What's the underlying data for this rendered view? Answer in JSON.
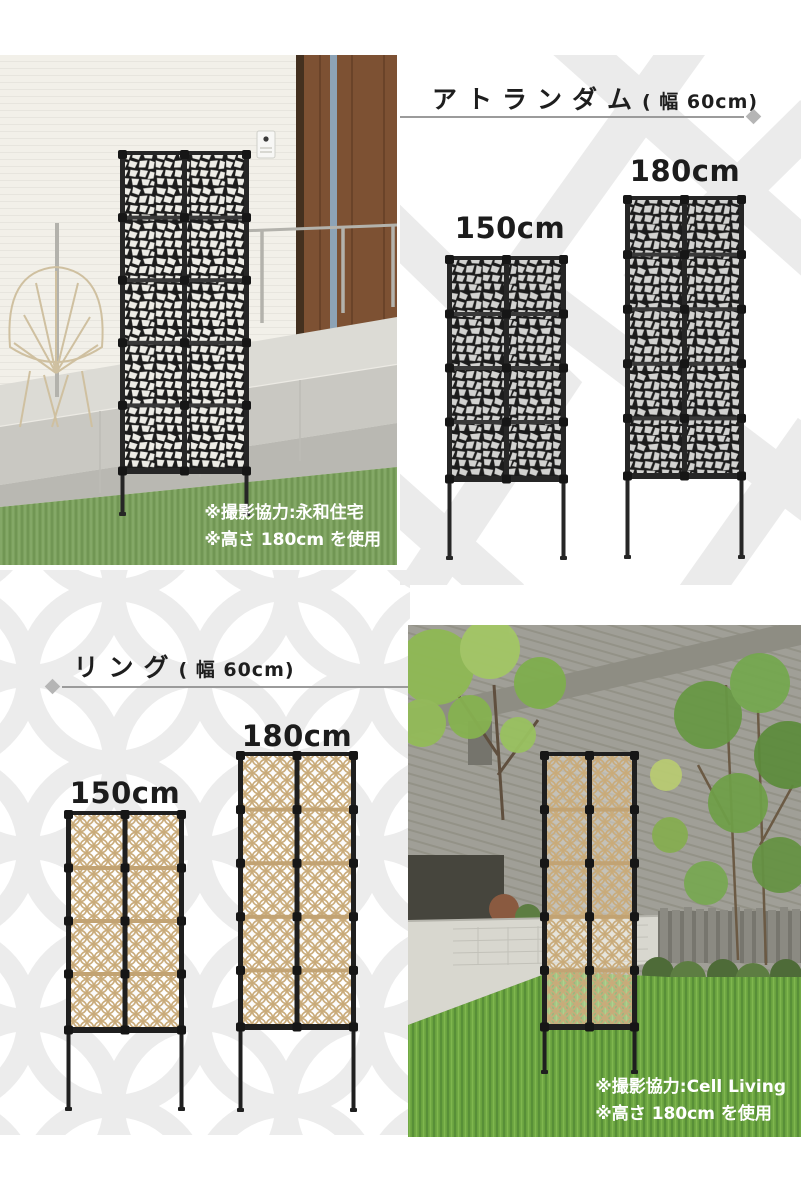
{
  "sections": {
    "atrandom": {
      "title": "アトランダム",
      "width_note": "( 幅 60cm)",
      "panel_style": "random",
      "sizes": [
        {
          "label": "150cm",
          "rows": 4,
          "cols": 2
        },
        {
          "label": "180cm",
          "rows": 5,
          "cols": 2
        }
      ]
    },
    "ring": {
      "title": "リング",
      "width_note": "( 幅 60cm)",
      "panel_style": "ring",
      "sizes": [
        {
          "label": "150cm",
          "rows": 4,
          "cols": 2
        },
        {
          "label": "180cm",
          "rows": 5,
          "cols": 2
        }
      ]
    }
  },
  "photos": {
    "atrandom": {
      "caption_line1": "※撮影協力:永和住宅",
      "caption_line2": "※高さ 180cm を使用"
    },
    "ring": {
      "caption_line1": "※撮影協力:Cell Living",
      "caption_line2": "※高さ 180cm を使用"
    }
  },
  "colors": {
    "rule_line": "#9b9b9b",
    "rule_diamond": "#b5b5b5",
    "heading_text": "#1e1e1e",
    "caption_text": "#ffffff",
    "watermark": "#ebebeb",
    "screen_frame_black": "#262626",
    "ring_lattice_beige": "#c9ab7a"
  }
}
